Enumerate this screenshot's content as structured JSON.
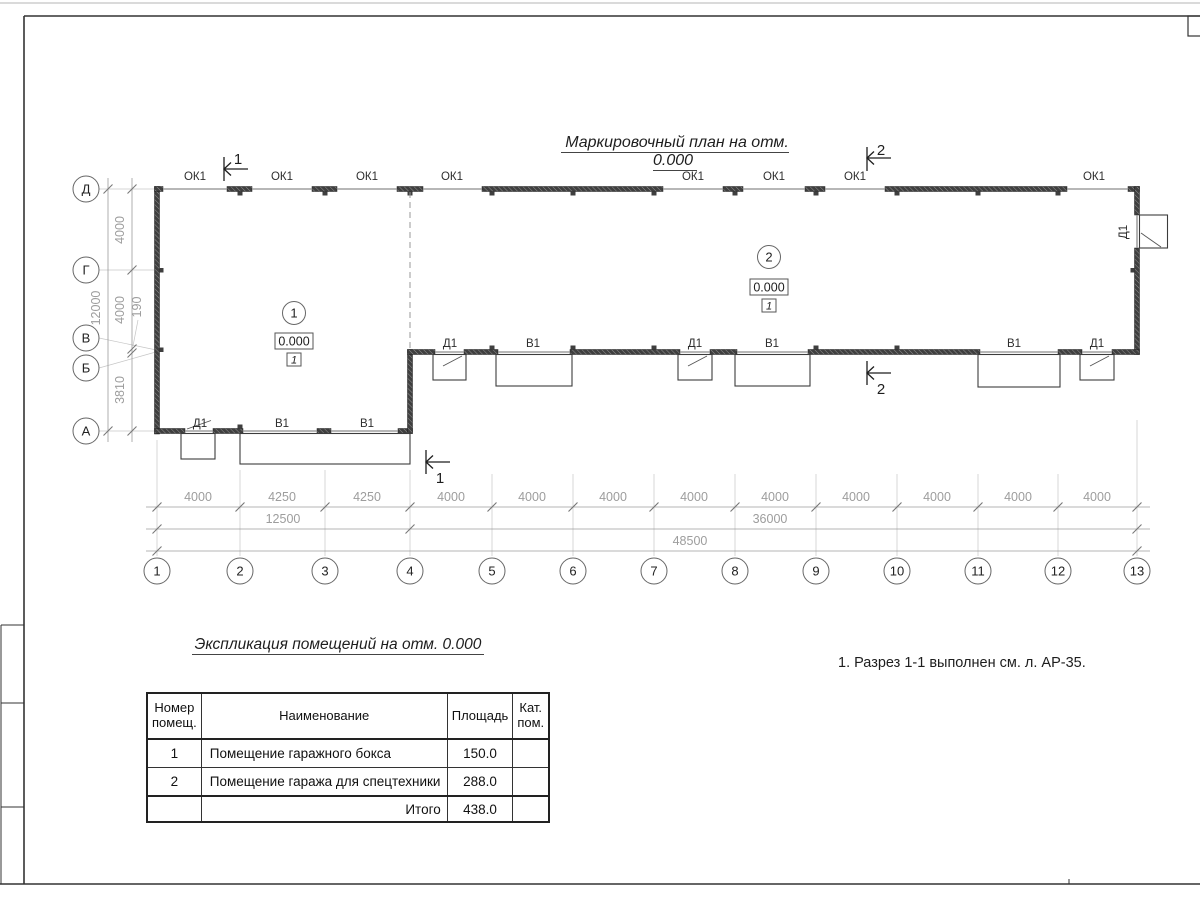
{
  "sheet": {
    "plan_title": "Маркировочный план на отм. 0.000",
    "note": "1. Разрез 1-1 выполнен см. л. АР-35."
  },
  "plan": {
    "labels": {
      "window": "ОК1",
      "door": "Д1",
      "gate": "В1"
    },
    "sections": {
      "s1": "1",
      "s2": "2"
    },
    "rooms": [
      {
        "number": "1",
        "elevation": "0.000",
        "floor_type": "1"
      },
      {
        "number": "2",
        "elevation": "0.000",
        "floor_type": "1"
      }
    ],
    "axes": {
      "letters": [
        "Д",
        "Г",
        "В",
        "Б",
        "А"
      ],
      "numbers": [
        "1",
        "2",
        "3",
        "4",
        "5",
        "6",
        "7",
        "8",
        "9",
        "10",
        "11",
        "12",
        "13"
      ]
    },
    "dims": {
      "left_bays": [
        "4000",
        "4000",
        "190",
        "3810"
      ],
      "left_total": "12000",
      "bays": [
        "4000",
        "4250",
        "4250",
        "4000",
        "4000",
        "4000",
        "4000",
        "4000",
        "4000",
        "4000",
        "4000",
        "4000"
      ],
      "group_left": "12500",
      "group_right": "36000",
      "total": "48500"
    }
  },
  "table": {
    "title": "Экспликация помещений на отм. 0.000",
    "headers": {
      "num": "Номер помещ.",
      "name": "Наименование",
      "area": "Площадь",
      "cat": "Кат. пом."
    },
    "rows": [
      {
        "num": "1",
        "name": "Помещение гаражного бокса",
        "area": "150.0",
        "cat": ""
      },
      {
        "num": "2",
        "name": "Помещение гаража для спецтехники",
        "area": "288.0",
        "cat": ""
      }
    ],
    "total": {
      "label": "Итого",
      "value": "438.0"
    }
  }
}
